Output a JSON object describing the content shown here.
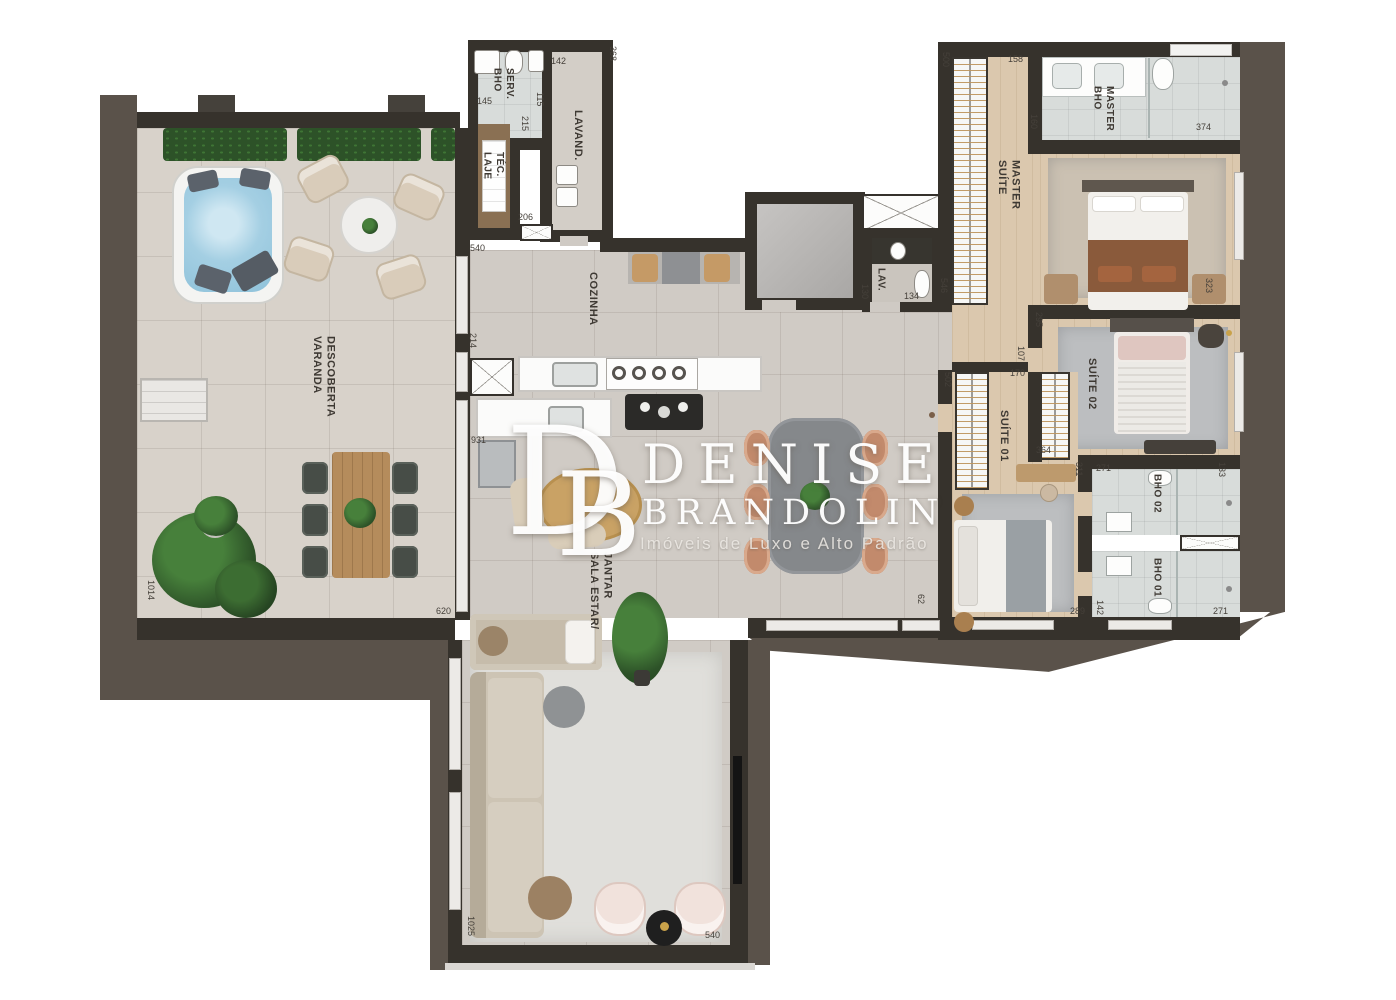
{
  "watermark": {
    "monogram_d": "D",
    "monogram_b": "B",
    "name_line1": "DENISE",
    "name_line2": "BRANDOLIN",
    "tagline": "Imóveis de Luxo e Alto Padrão"
  },
  "rooms": {
    "varanda": "VARANDA\nDESCOBERTA",
    "laje_tec": "LAJE\nTÉC.",
    "bho_serv": "BHO\nSERV.",
    "lavand": "LAVAND.",
    "cozinha": "COZINHA",
    "sala": "SALA ESTAR/\nJANTAR",
    "lav": "LAV.",
    "suite_master": "SUÍTE\nMASTER",
    "bho_master": "BHO\nMASTER",
    "suite_02": "SUÍTE 02",
    "suite_01": "SUÍTE 01",
    "bho_02": "BHO 02",
    "bho_01": "BHO 01"
  },
  "dims": [
    "145",
    "115",
    "142",
    "368",
    "215",
    "206",
    "540",
    "214",
    "931",
    "620",
    "1014",
    "1025",
    "540",
    "130",
    "134",
    "62",
    "500",
    "158",
    "160",
    "374",
    "546",
    "323",
    "295",
    "107",
    "170",
    "502",
    "364",
    "311",
    "271",
    "133",
    "289",
    "142",
    "271"
  ],
  "colors": {
    "outer_wall": "#5a524a",
    "inner_wall": "#36322c",
    "tile_floor": "#d0cbc5",
    "varanda_floor": "#d8d2ca",
    "wood_floor": "#dbc8ae",
    "bath_floor": "#d8dcda",
    "rug": "#e0dfdb",
    "jacuzzi_water": "#a4cfe3",
    "plant_green": "#2d5228",
    "dining_table": "#85888b",
    "copper_chair": "#c28a6c",
    "master_blanket": "#8a5a3b",
    "watermark_text": "#ffffff"
  }
}
